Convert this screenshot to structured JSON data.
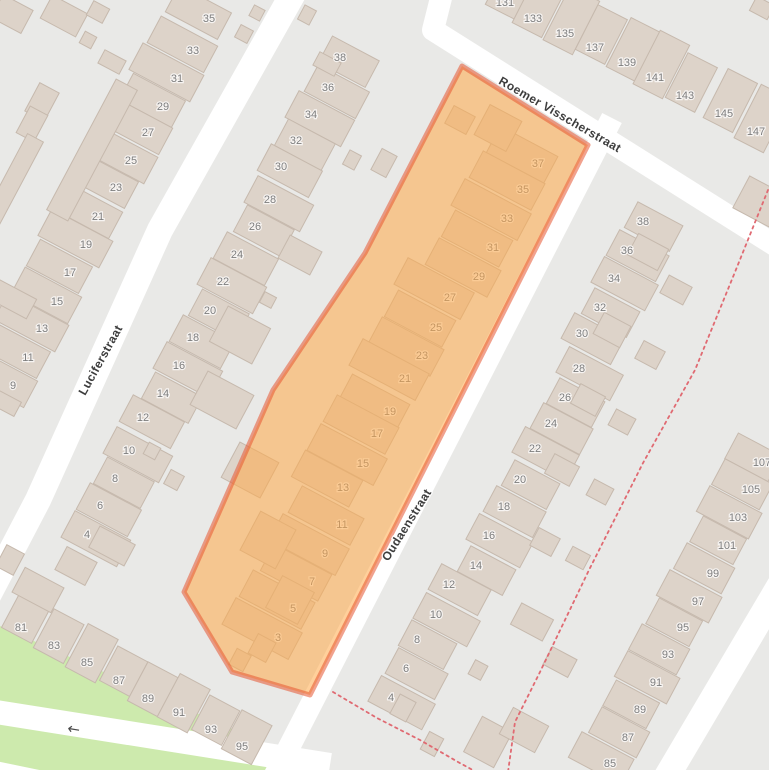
{
  "map": {
    "colors": {
      "background": "#e9e9e7",
      "road": "#ffffff",
      "building_fill": "#ddd3c9",
      "building_stroke": "#c6b9ad",
      "green": "#cdeaad",
      "number_text": "#7d7d7d",
      "street_text": "#3d3d3d",
      "dashed_path": "#e06a72",
      "highlight_fill": "rgba(255,169,72,0.55)",
      "highlight_stroke": "rgba(230,85,50,0.55)"
    },
    "streets": [
      {
        "name": "Luciferstraat",
        "label": {
          "x": 104,
          "y": 362,
          "angle": -61
        },
        "line": [
          [
            295,
            -10
          ],
          [
            160,
            230
          ],
          [
            38,
            500
          ],
          [
            -30,
            630
          ]
        ],
        "width": 26
      },
      {
        "name": "Roemer Visscherstraat",
        "label": {
          "x": 558,
          "y": 118,
          "angle": 30
        },
        "line": [
          [
            443,
            -10
          ],
          [
            433,
            30
          ],
          [
            792,
            256
          ]
        ],
        "width": 22
      },
      {
        "name": "Oudaenstraat",
        "label": {
          "x": 410,
          "y": 527,
          "angle": -58
        },
        "line": [
          [
            612,
            118
          ],
          [
            262,
            800
          ]
        ],
        "width": 22
      },
      {
        "name": "",
        "line": [
          [
            -10,
            711
          ],
          [
            330,
            765
          ]
        ],
        "width": 24
      },
      {
        "name": "",
        "line": [
          [
            -10,
            770
          ],
          [
            135,
            800
          ]
        ],
        "width": 20
      },
      {
        "name": "",
        "line": [
          [
            780,
            585
          ],
          [
            650,
            805
          ]
        ],
        "width": 26
      }
    ],
    "oneway_arrow": {
      "x": 73,
      "y": 734,
      "angle": 9,
      "glyph": "←"
    },
    "green_areas": [
      [
        [
          0,
          626
        ],
        [
          298,
          758
        ],
        [
          286,
          778
        ],
        [
          0,
          778
        ]
      ]
    ],
    "dashed_paths": [
      [
        [
          768,
          190
        ],
        [
          735,
          272
        ],
        [
          695,
          370
        ],
        [
          643,
          463
        ],
        [
          589,
          570
        ],
        [
          540,
          672
        ],
        [
          515,
          722
        ],
        [
          508,
          772
        ]
      ],
      [
        [
          333,
          692
        ],
        [
          377,
          718
        ],
        [
          420,
          740
        ],
        [
          458,
          762
        ],
        [
          482,
          775
        ]
      ]
    ],
    "highlight": {
      "points": [
        [
          462,
          66
        ],
        [
          588,
          145
        ],
        [
          310,
          695
        ],
        [
          232,
          672
        ],
        [
          184,
          592
        ],
        [
          273,
          390
        ],
        [
          365,
          253
        ]
      ],
      "stroke_width": 5
    },
    "building_rows": [
      {
        "angle": -62,
        "house_w": 30,
        "depth": 64,
        "shift": -12,
        "labels": [
          [
            "35",
            209,
            18
          ],
          [
            "33",
            193,
            50
          ],
          [
            "31",
            177,
            78
          ],
          [
            "29",
            163,
            106
          ],
          [
            "27",
            148,
            132
          ],
          [
            "25",
            131,
            160
          ],
          [
            "23",
            116,
            187
          ],
          [
            "21",
            98,
            216
          ],
          [
            "19",
            86,
            244
          ],
          [
            "17",
            70,
            272
          ],
          [
            "15",
            57,
            301
          ],
          [
            "13",
            42,
            328
          ],
          [
            "11",
            28,
            357
          ],
          [
            "9",
            13,
            385
          ]
        ]
      },
      {
        "angle": -62,
        "house_w": 30,
        "depth": 58,
        "shift": 10,
        "labels": [
          [
            "38",
            340,
            57
          ],
          [
            "36",
            328,
            87
          ],
          [
            "34",
            311,
            114
          ],
          [
            "32",
            296,
            140
          ],
          [
            "30",
            281,
            166
          ],
          [
            "28",
            270,
            199
          ],
          [
            "26",
            255,
            226
          ],
          [
            "24",
            237,
            254
          ],
          [
            "22",
            223,
            281
          ],
          [
            "20",
            210,
            310
          ],
          [
            "18",
            193,
            337
          ],
          [
            "16",
            179,
            365
          ],
          [
            "14",
            163,
            393
          ],
          [
            "12",
            143,
            417
          ],
          [
            "10",
            129,
            450
          ],
          [
            "8",
            115,
            478
          ],
          [
            "6",
            100,
            505
          ],
          [
            "4",
            87,
            534
          ]
        ]
      },
      {
        "angle": -62,
        "house_w": 30,
        "depth": 70,
        "shift": -18,
        "labels": [
          [
            "37",
            538,
            163
          ],
          [
            "35",
            523,
            189
          ],
          [
            "33",
            507,
            218
          ],
          [
            "31",
            493,
            247
          ],
          [
            "29",
            479,
            276
          ],
          [
            "27",
            450,
            297
          ],
          [
            "25",
            436,
            327
          ],
          [
            "23",
            422,
            355
          ],
          [
            "21",
            405,
            378
          ],
          [
            "19",
            390,
            411
          ],
          [
            "17",
            377,
            433
          ],
          [
            "15",
            363,
            463
          ],
          [
            "13",
            343,
            487
          ],
          [
            "11",
            342,
            524
          ],
          [
            "9",
            325,
            553
          ],
          [
            "7",
            312,
            581
          ],
          [
            "5",
            293,
            608
          ],
          [
            "3",
            278,
            637
          ]
        ]
      },
      {
        "angle": -62,
        "house_w": 29,
        "depth": 56,
        "shift": 12,
        "labels": [
          [
            "38",
            643,
            221
          ],
          [
            "36",
            627,
            250
          ],
          [
            "34",
            614,
            278
          ],
          [
            "32",
            600,
            307
          ],
          [
            "30",
            582,
            333
          ],
          [
            "28",
            579,
            368
          ],
          [
            "26",
            565,
            397
          ],
          [
            "24",
            551,
            423
          ],
          [
            "22",
            535,
            448
          ],
          [
            "20",
            520,
            479
          ],
          [
            "18",
            504,
            506
          ],
          [
            "16",
            489,
            535
          ],
          [
            "14",
            476,
            565
          ],
          [
            "12",
            449,
            584
          ],
          [
            "10",
            436,
            614
          ],
          [
            "8",
            417,
            639
          ],
          [
            "6",
            406,
            668
          ],
          [
            "4",
            391,
            697
          ]
        ]
      },
      {
        "angle": 27,
        "house_w": 33,
        "depth": 55,
        "shift": -14,
        "labels": [
          [
            "131",
            505,
            2
          ],
          [
            "133",
            533,
            18
          ],
          [
            "135",
            565,
            33
          ],
          [
            "137",
            595,
            47
          ],
          [
            "139",
            627,
            62
          ],
          [
            "141",
            655,
            77
          ],
          [
            "143",
            685,
            95
          ],
          [
            "145",
            724,
            113
          ],
          [
            "147",
            756,
            131
          ]
        ]
      },
      {
        "angle": -62,
        "house_w": 29,
        "depth": 54,
        "shift": -10,
        "labels": [
          [
            "107",
            762,
            462
          ],
          [
            "105",
            751,
            489
          ],
          [
            "103",
            738,
            517
          ],
          [
            "101",
            727,
            545
          ],
          [
            "99",
            713,
            573
          ],
          [
            "97",
            698,
            601
          ],
          [
            "95",
            683,
            627
          ],
          [
            "93",
            668,
            654
          ],
          [
            "91",
            656,
            682
          ],
          [
            "89",
            640,
            709
          ],
          [
            "87",
            628,
            737
          ],
          [
            "85",
            610,
            763
          ]
        ]
      },
      {
        "angle": 28,
        "house_w": 34,
        "depth": 44,
        "shift": -10,
        "labels": [
          [
            "81",
            21,
            627
          ],
          [
            "83",
            54,
            645
          ],
          [
            "85",
            87,
            662
          ],
          [
            "87",
            119,
            680
          ],
          [
            "89",
            148,
            698
          ],
          [
            "91",
            179,
            712
          ],
          [
            "93",
            211,
            729
          ],
          [
            "95",
            242,
            746
          ]
        ]
      }
    ],
    "extra_buildings": [
      [
        12,
        14,
        26,
        34,
        -62
      ],
      [
        64,
        16,
        26,
        40,
        -62
      ],
      [
        98,
        12,
        16,
        18,
        -62
      ],
      [
        88,
        40,
        13,
        13,
        -62
      ],
      [
        112,
        62,
        24,
        15,
        28
      ],
      [
        42,
        102,
        32,
        22,
        -62
      ],
      [
        32,
        124,
        30,
        20,
        -62
      ],
      [
        92,
        150,
        148,
        24,
        -62
      ],
      [
        12,
        182,
        100,
        18,
        -62
      ],
      [
        5,
        295,
        22,
        60,
        -62
      ],
      [
        0,
        400,
        16,
        40,
        -62
      ],
      [
        244,
        34,
        14,
        14,
        -62
      ],
      [
        257,
        13,
        12,
        12,
        -62
      ],
      [
        307,
        15,
        16,
        13,
        -62
      ],
      [
        327,
        64,
        24,
        15,
        28
      ],
      [
        352,
        160,
        16,
        13,
        -62
      ],
      [
        384,
        163,
        24,
        17,
        -62
      ],
      [
        268,
        300,
        12,
        13,
        -62
      ],
      [
        174,
        480,
        16,
        15,
        -62
      ],
      [
        152,
        451,
        13,
        13,
        -62
      ],
      [
        112,
        546,
        40,
        24,
        28
      ],
      [
        76,
        566,
        34,
        26,
        28
      ],
      [
        38,
        590,
        44,
        28,
        28
      ],
      [
        10,
        560,
        20,
        24,
        28
      ],
      [
        648,
        252,
        24,
        34,
        -62
      ],
      [
        676,
        290,
        20,
        26,
        -62
      ],
      [
        612,
        330,
        24,
        30,
        -62
      ],
      [
        650,
        355,
        20,
        24,
        -62
      ],
      [
        588,
        400,
        22,
        28,
        -62
      ],
      [
        622,
        422,
        18,
        22,
        -62
      ],
      [
        562,
        470,
        22,
        28,
        -62
      ],
      [
        600,
        492,
        18,
        22,
        -62
      ],
      [
        545,
        542,
        20,
        24,
        -62
      ],
      [
        578,
        558,
        16,
        20,
        -62
      ],
      [
        532,
        622,
        24,
        36,
        -62
      ],
      [
        560,
        662,
        20,
        28,
        -62
      ],
      [
        403,
        708,
        22,
        18,
        -62
      ],
      [
        432,
        744,
        20,
        16,
        -62
      ],
      [
        488,
        742,
        40,
        34,
        -62
      ],
      [
        524,
        730,
        30,
        40,
        -62
      ],
      [
        478,
        670,
        16,
        14,
        -62
      ],
      [
        762,
        8,
        20,
        16,
        28
      ],
      [
        766,
        205,
        36,
        56,
        -62
      ],
      [
        300,
        255,
        26,
        36,
        -62
      ],
      [
        240,
        335,
        40,
        48,
        -62
      ],
      [
        222,
        400,
        38,
        52,
        -62
      ],
      [
        250,
        470,
        40,
        44,
        -62
      ],
      [
        268,
        540,
        44,
        40,
        -62
      ],
      [
        290,
        600,
        36,
        36,
        -62
      ],
      [
        262,
        648,
        22,
        20,
        -62
      ],
      [
        240,
        660,
        18,
        16,
        -62
      ],
      [
        498,
        128,
        34,
        36,
        -62
      ],
      [
        460,
        120,
        20,
        24,
        -62
      ]
    ]
  }
}
